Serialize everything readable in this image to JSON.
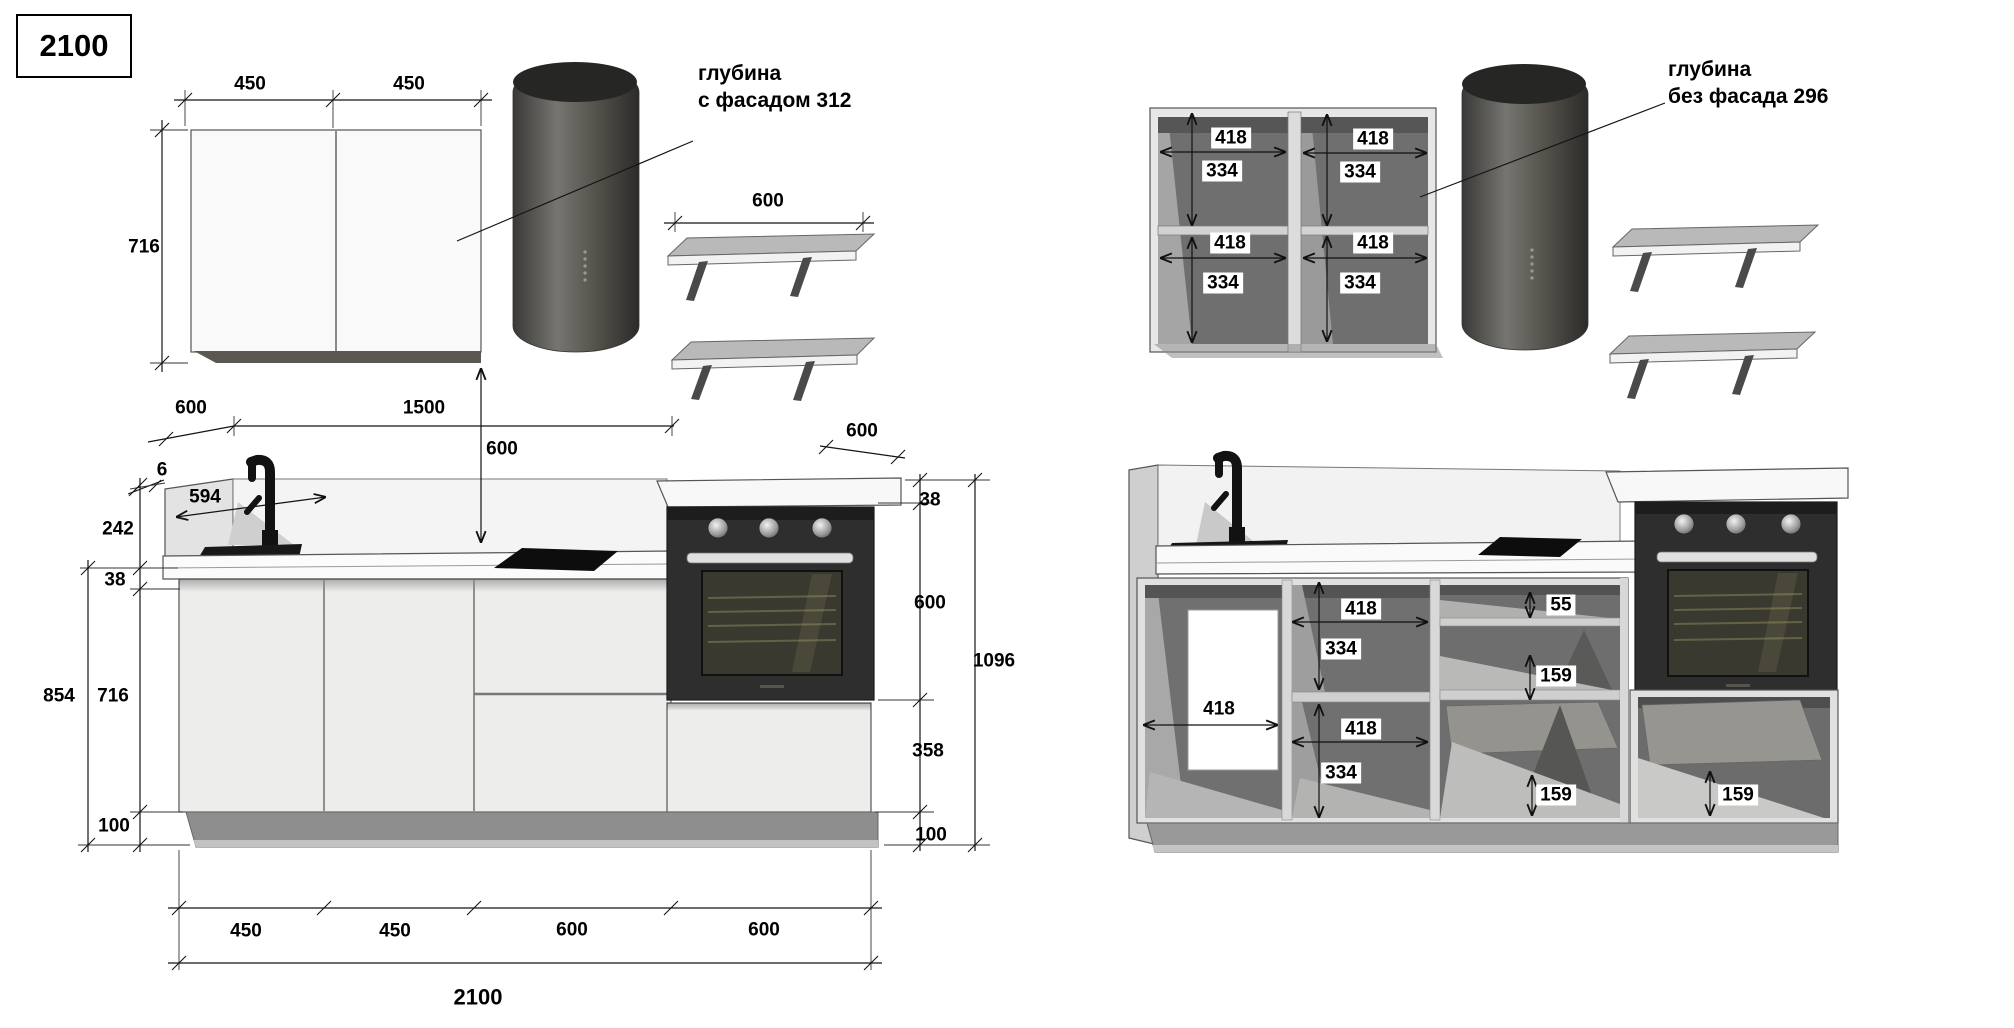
{
  "title_box": {
    "label": "2100"
  },
  "annotations": {
    "with_facade_line1": "глубина",
    "with_facade_line2": "с фасадом 312",
    "without_facade_line1": "глубина",
    "without_facade_line2": "без фасада 296"
  },
  "left_view": {
    "wall_cabinet": {
      "door_a": "450",
      "door_b": "450",
      "height": "716"
    },
    "shelf": {
      "width": "600"
    },
    "clearances": {
      "left_offset": "600",
      "span": "1500",
      "hood_height": "600",
      "oven_top_depth": "600"
    },
    "left_column": {
      "splash_edge": "6",
      "splash_depth": "594",
      "splash_height": "242",
      "counter": "38",
      "total": "854",
      "cabinet": "716",
      "plinth": "100"
    },
    "right_column": {
      "counter": "38",
      "oven": "600",
      "total": "1096",
      "drawer": "358",
      "plinth": "100"
    },
    "bottom_row": {
      "m1": "450",
      "m2": "450",
      "m3": "600",
      "m4": "600",
      "total": "2100"
    }
  },
  "right_view": {
    "wall_cabinet": {
      "tl_w": "418",
      "tl_h": "334",
      "tr_w": "418",
      "tr_h": "334",
      "bl_w": "418",
      "bl_h": "334",
      "br_w": "418",
      "br_h": "334"
    },
    "base": {
      "sink_w": "418",
      "mid_top_w": "418",
      "mid_top_h": "334",
      "mid_bot_w": "418",
      "mid_bot_h": "334",
      "top_drawer": "55",
      "mid_drawer": "159",
      "bottom_drawer": "159",
      "oven_drawer": "159"
    }
  }
}
